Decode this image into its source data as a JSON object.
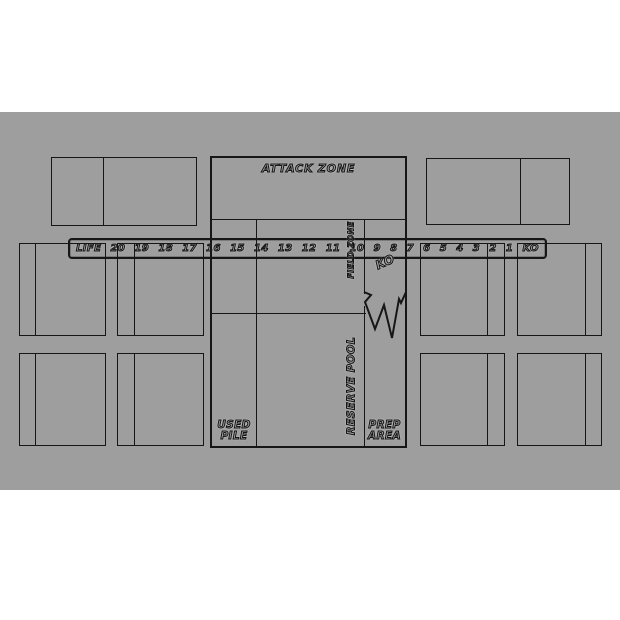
{
  "meta": {
    "description": "Trading card game playmat template",
    "colors": {
      "background": "#ffffff",
      "mat": "#9e9e9e",
      "line": "#161616"
    }
  },
  "life_track": {
    "label": "LIFE",
    "values": [
      "20",
      "19",
      "18",
      "17",
      "16",
      "15",
      "14",
      "13",
      "12",
      "11",
      "10",
      "9",
      "8",
      "7",
      "6",
      "5",
      "4",
      "3",
      "2",
      "1",
      "KO"
    ]
  },
  "zones": {
    "attack_zone": "ATTACK ZONE",
    "field_zone": "FIELD ZONE",
    "ko_zone": "KO",
    "reserve_pool": "RESERVE POOL",
    "used_pile": [
      "USED",
      "PILE"
    ],
    "prep_area": [
      "PREP",
      "AREA"
    ]
  }
}
